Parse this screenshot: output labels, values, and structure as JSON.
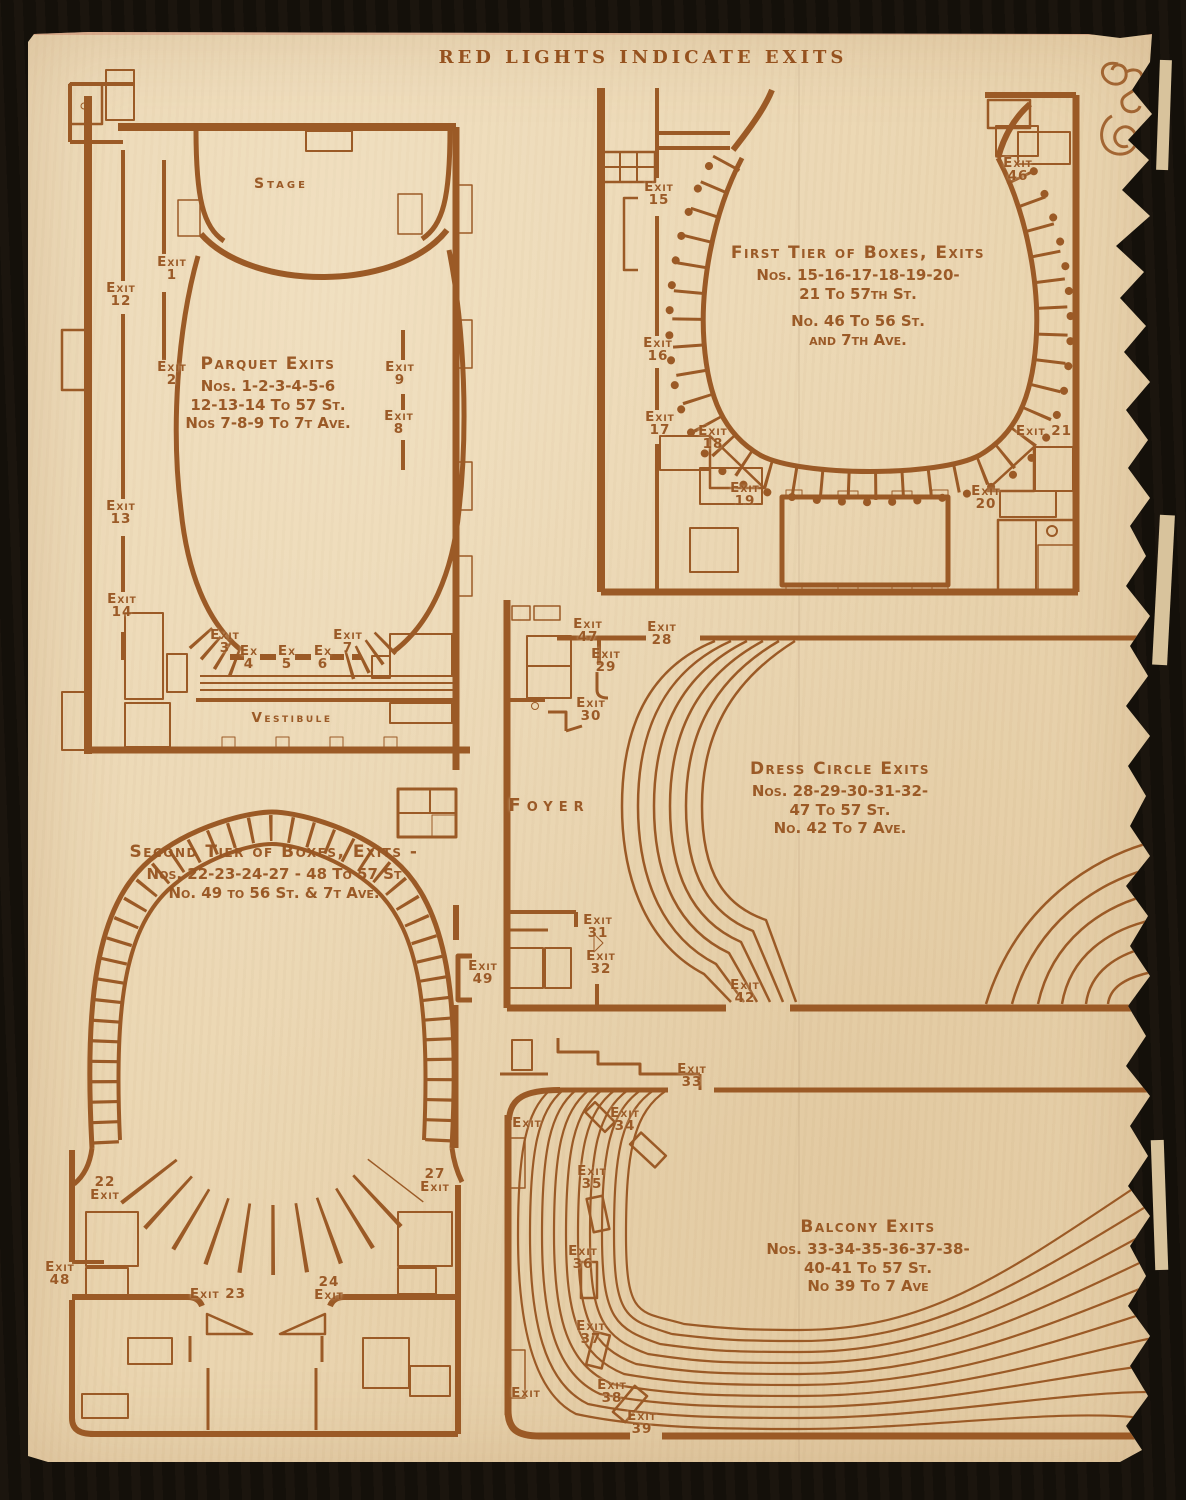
{
  "page": {
    "header": "RED LIGHTS INDICATE EXITS",
    "colors": {
      "ink": "#9b5a26",
      "paper": "#ead5b0",
      "background": "#14100a"
    },
    "decorations": {
      "top_right": "printers-ornament-icon"
    }
  },
  "plans": [
    {
      "id": "parquet",
      "name": "Parquet level floor plan",
      "block": {
        "x": 268,
        "y": 354,
        "title": "Parquet Exits",
        "lines": [
          "Nos. 1-2-3-4-5-6",
          "12-13-14 To 57 St.",
          "Nos 7-8-9 To 7t Ave."
        ]
      },
      "area_labels": [
        {
          "text": "Stage",
          "x": 281,
          "y": 176,
          "size": 14,
          "ls": 3
        },
        {
          "text": "Vestibule",
          "x": 292,
          "y": 710,
          "size": 13.5,
          "ls": 2.5
        }
      ],
      "exits": [
        {
          "lines": [
            "Exit",
            "1"
          ],
          "x": 172,
          "y": 256
        },
        {
          "lines": [
            "Exit",
            "12"
          ],
          "x": 121,
          "y": 282
        },
        {
          "lines": [
            "Exit",
            "2"
          ],
          "x": 172,
          "y": 361
        },
        {
          "lines": [
            "Exit",
            "9"
          ],
          "x": 400,
          "y": 361
        },
        {
          "lines": [
            "Exit",
            "8"
          ],
          "x": 399,
          "y": 410
        },
        {
          "lines": [
            "Exit",
            "13"
          ],
          "x": 121,
          "y": 500
        },
        {
          "lines": [
            "Exit",
            "14"
          ],
          "x": 122,
          "y": 593
        },
        {
          "lines": [
            "Exit",
            "3"
          ],
          "x": 225,
          "y": 629
        },
        {
          "lines": [
            "Ex",
            "4"
          ],
          "x": 249,
          "y": 645
        },
        {
          "lines": [
            "Ex",
            "5"
          ],
          "x": 287,
          "y": 645
        },
        {
          "lines": [
            "Ex",
            "6"
          ],
          "x": 323,
          "y": 645
        },
        {
          "lines": [
            "Exit",
            "7"
          ],
          "x": 348,
          "y": 629
        }
      ]
    },
    {
      "id": "first-tier",
      "name": "First tier of boxes floor plan",
      "block": {
        "x": 858,
        "y": 243,
        "title": "First Tier of Boxes, Exits",
        "lines": [
          "Nos. 15-16-17-18-19-20-",
          "21 To 57th St.",
          "No. 46 To 56 St.",
          "and 7th Ave."
        ],
        "gap_before": 2
      },
      "area_labels": [],
      "exits": [
        {
          "lines": [
            "Exit",
            "15"
          ],
          "x": 659,
          "y": 181
        },
        {
          "lines": [
            "Exit",
            "16"
          ],
          "x": 658,
          "y": 337
        },
        {
          "lines": [
            "Exit",
            "17"
          ],
          "x": 660,
          "y": 411
        },
        {
          "lines": [
            "Exit",
            "18"
          ],
          "x": 713,
          "y": 425
        },
        {
          "lines": [
            "Exit",
            "19"
          ],
          "x": 745,
          "y": 482
        },
        {
          "lines": [
            "Exit",
            "46"
          ],
          "x": 1018,
          "y": 157
        },
        {
          "lines": [
            "Exit 21"
          ],
          "x": 1044,
          "y": 425
        },
        {
          "lines": [
            "Exit",
            "20"
          ],
          "x": 986,
          "y": 485
        }
      ]
    },
    {
      "id": "dress-circle",
      "name": "Dress circle floor plan",
      "block": {
        "x": 840,
        "y": 759,
        "title": "Dress Circle Exits",
        "lines": [
          "Nos. 28-29-30-31-32-",
          "47 To 57 St.",
          "No. 42 To 7 Ave."
        ]
      },
      "area_labels": [
        {
          "text": "Foyer",
          "x": 549,
          "y": 795,
          "size": 18,
          "ls": 6
        }
      ],
      "exits": [
        {
          "lines": [
            "Exit",
            "47"
          ],
          "x": 588,
          "y": 618
        },
        {
          "lines": [
            "Exit",
            "28"
          ],
          "x": 662,
          "y": 621
        },
        {
          "lines": [
            "Exit",
            "29"
          ],
          "x": 606,
          "y": 648
        },
        {
          "lines": [
            "Exit",
            "30"
          ],
          "x": 591,
          "y": 697
        },
        {
          "lines": [
            "Exit",
            "31"
          ],
          "x": 598,
          "y": 914
        },
        {
          "lines": [
            "Exit",
            "32"
          ],
          "x": 601,
          "y": 950
        },
        {
          "lines": [
            "Exit",
            "42"
          ],
          "x": 745,
          "y": 979
        }
      ]
    },
    {
      "id": "second-tier",
      "name": "Second tier of boxes floor plan",
      "block": {
        "x": 274,
        "y": 842,
        "title": "Second Tier of Boxes, Exits -",
        "lines": [
          "Nos. 22-23-24-27 - 48 To 57 St",
          "No. 49 to 56 St. & 7t Ave."
        ]
      },
      "area_labels": [],
      "exits": [
        {
          "lines": [
            "Exit",
            "49"
          ],
          "x": 483,
          "y": 960
        },
        {
          "lines": [
            "22",
            "Exit"
          ],
          "x": 105,
          "y": 1176
        },
        {
          "lines": [
            "27",
            "Exit"
          ],
          "x": 435,
          "y": 1168
        },
        {
          "lines": [
            "Exit",
            "48"
          ],
          "x": 60,
          "y": 1261
        },
        {
          "lines": [
            "Exit 23"
          ],
          "x": 218,
          "y": 1288
        },
        {
          "lines": [
            "24",
            "Exit"
          ],
          "x": 329,
          "y": 1276
        }
      ]
    },
    {
      "id": "balcony",
      "name": "Balcony floor plan",
      "block": {
        "x": 868,
        "y": 1217,
        "title": "Balcony Exits",
        "lines": [
          "Nos. 33-34-35-36-37-38-",
          "40-41 To 57 St.",
          "No 39 To 7 Ave"
        ]
      },
      "area_labels": [],
      "exits": [
        {
          "lines": [
            "Exit",
            "33"
          ],
          "x": 692,
          "y": 1063
        },
        {
          "lines": [
            "Exit"
          ],
          "x": 527,
          "y": 1117
        },
        {
          "lines": [
            "Exit",
            "34"
          ],
          "x": 625,
          "y": 1107
        },
        {
          "lines": [
            "Exit",
            "35"
          ],
          "x": 592,
          "y": 1165
        },
        {
          "lines": [
            "Exit",
            "36"
          ],
          "x": 583,
          "y": 1245
        },
        {
          "lines": [
            "Exit",
            "37"
          ],
          "x": 591,
          "y": 1320
        },
        {
          "lines": [
            "Exit",
            "38"
          ],
          "x": 612,
          "y": 1379
        },
        {
          "lines": [
            "Exit"
          ],
          "x": 526,
          "y": 1387
        },
        {
          "lines": [
            "Exit",
            "39"
          ],
          "x": 642,
          "y": 1410
        }
      ]
    }
  ]
}
